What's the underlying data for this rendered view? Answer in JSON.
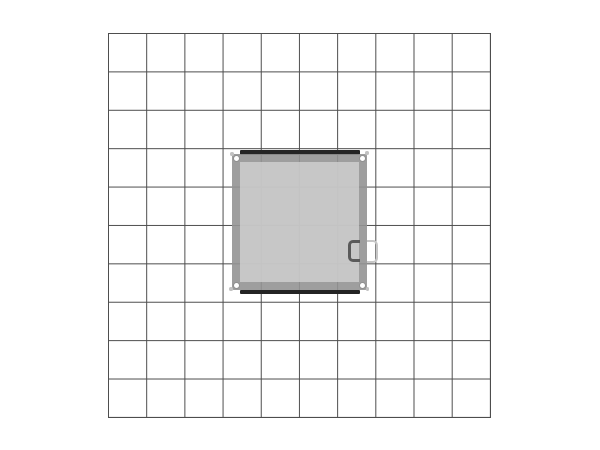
{
  "scene": {
    "description": "Plan view drawing: square counter with right-side door handle centered on a 10 by 10 floor grid",
    "background_color": "#ffffff"
  },
  "grid": {
    "columns": 10,
    "rows": 10,
    "line_color": "#4d4d4d"
  },
  "object": {
    "shape": "square",
    "handle_side": "right",
    "frame_color": "rgba(148,148,148,0.9)",
    "interior_color": "rgba(210,210,210,0.78)",
    "rail_color": "#242424",
    "fastener": {
      "dot_color": "#ffffff",
      "ring_color": "#8f8f8f",
      "satellite_color": "#c2c2c2"
    },
    "handle": {
      "inner_color": "#5a5a5a",
      "outer_color": "#c6c6c6"
    }
  }
}
